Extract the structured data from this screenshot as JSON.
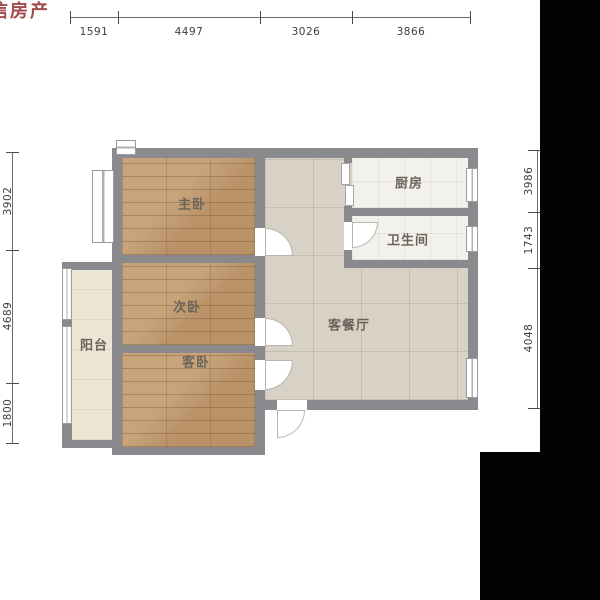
{
  "watermark": {
    "text": "信房产",
    "color": "#a04a4a"
  },
  "dimensions": {
    "unit": "mm",
    "top": [
      "1591",
      "4497",
      "3026",
      "3866"
    ],
    "left": [
      "3902",
      "4689",
      "1800"
    ],
    "right": [
      "3986",
      "1743",
      "4048"
    ]
  },
  "rooms": {
    "master_bedroom": "主卧",
    "second_bedroom": "次卧",
    "guest_bedroom": "客卧",
    "balcony": "阳台",
    "living_dining": "客餐厅",
    "kitchen": "厨房",
    "bathroom": "卫生间"
  },
  "colors": {
    "wall": "#8a8a8e",
    "wood_floor": "#c49c70",
    "tile_floor": "#d8d1c5",
    "balcony_floor": "#ebe5d4",
    "light_floor": "#f3f1ec",
    "watermark": "#a04a4a",
    "letterbox": "#030303",
    "dimension_text": "#3e3e3e"
  }
}
